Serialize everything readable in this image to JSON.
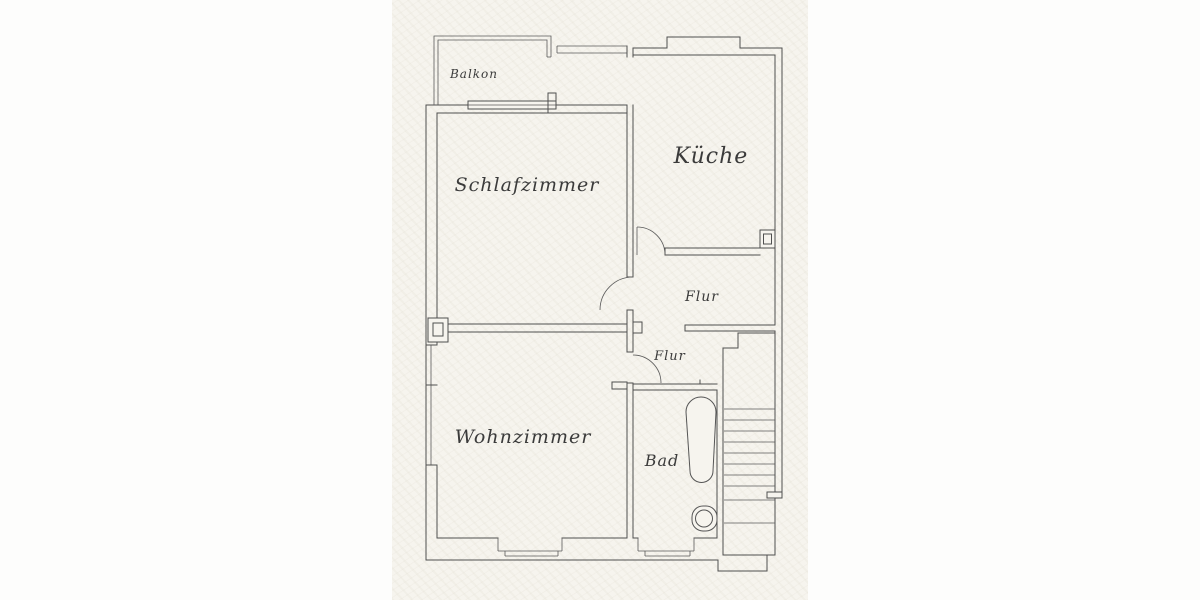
{
  "document": {
    "kind": "apartment floor plan (scanned drawing)"
  },
  "rooms": {
    "balkon": "Balkon",
    "schlafzimmer": "Schlafzimmer",
    "kueche": "Küche",
    "flur_upper": "Flur",
    "flur_lower": "Flur",
    "wohnzimmer": "Wohnzimmer",
    "bad": "Bad"
  },
  "fixtures": {
    "bathtub": "bathtub",
    "toilet": "toilet",
    "staircase": "staircase"
  },
  "colors": {
    "paper": "#f6f4ee",
    "line": "#4f4f4f",
    "text": "#3b3b3b"
  }
}
